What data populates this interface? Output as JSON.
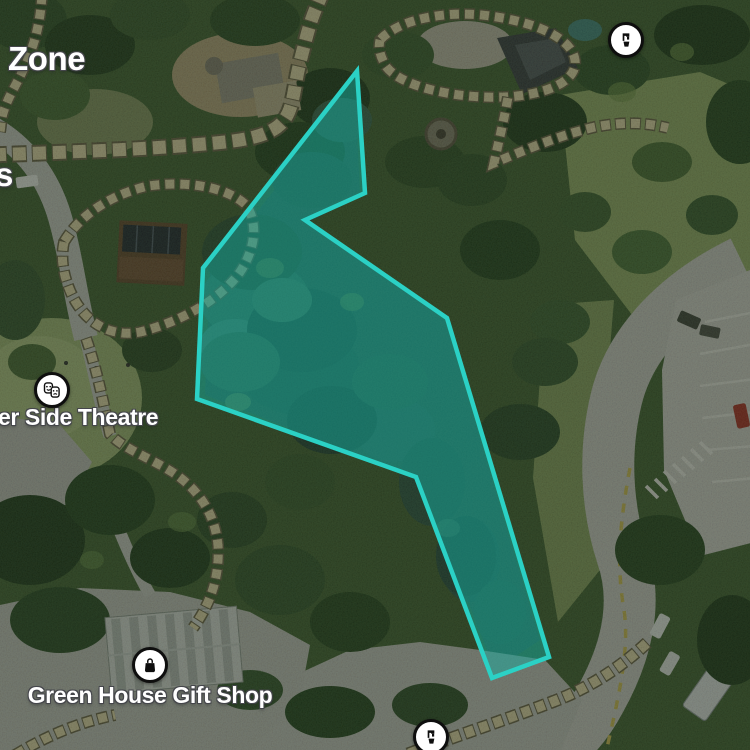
{
  "map": {
    "view": "satellite-with-park-overlay",
    "zone_label": "Zone",
    "edge_fragment_left": "s",
    "pois": [
      {
        "name": "drinking-fountain-north",
        "icon": "drinking-fountain-icon",
        "label": ""
      },
      {
        "name": "side-theatre",
        "icon": "theatre-masks-icon",
        "label": "er Side Theatre"
      },
      {
        "name": "gift-shop",
        "icon": "shopping-bag-icon",
        "label": "Green House Gift Shop"
      },
      {
        "name": "drinking-fountain-south",
        "icon": "drinking-fountain-icon",
        "label": ""
      }
    ],
    "selection": {
      "shape": "polygon",
      "points_attr": "357,71 365,193 305,220 447,318 549,657 492,678 416,477 197,399 203,268",
      "stroke_color": "#2bd1c5",
      "fill_color": "rgba(20,178,165,0.48)"
    },
    "colors": {
      "path_tile": "#e8dcb0",
      "path_tile_border": "#756c52",
      "road": "#d2d1cb",
      "curb_dash_yellow": "#d6c35e",
      "label_text": "#ffffff",
      "label_halo": "#45464b"
    }
  }
}
